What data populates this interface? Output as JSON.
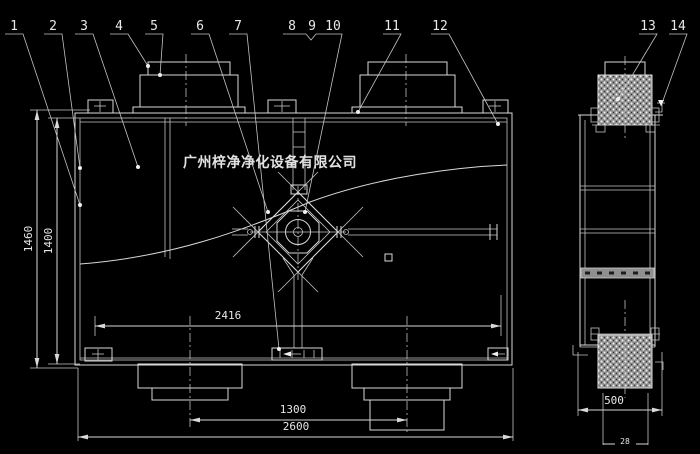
{
  "drawing": {
    "background_color": "#000000",
    "line_color": "#d9d9d9",
    "watermark": "广州梓净净化设备有限公司",
    "callouts": [
      "1",
      "2",
      "3",
      "4",
      "5",
      "6",
      "7",
      "8",
      "9",
      "10",
      "11",
      "12",
      "13",
      "14"
    ],
    "dimensions": {
      "overall_height": "1460",
      "body_height": "1400",
      "inner_width": "2416",
      "duct_spacing": "1300",
      "overall_width": "2600",
      "side_width": "500",
      "side_bottom": "28"
    }
  }
}
